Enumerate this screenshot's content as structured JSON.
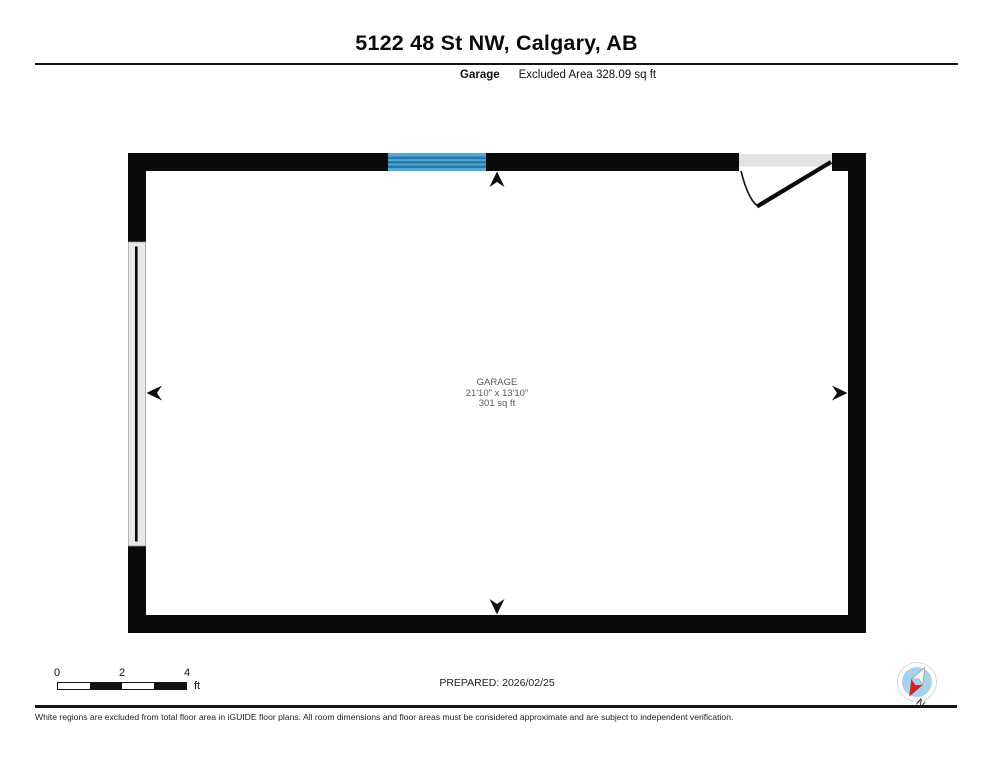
{
  "header": {
    "title": "5122 48 St NW, Calgary, AB",
    "floor_label": "Garage",
    "excluded_area": "Excluded Area 328.09 sq ft"
  },
  "room": {
    "name": "GARAGE",
    "dimensions": "21'10\" x 13'10\"",
    "area": "301 sq ft"
  },
  "footer": {
    "scale": {
      "ticks": [
        "0",
        "2",
        "4"
      ],
      "unit": "ft"
    },
    "prepared": "PREPARED: 2026/02/25",
    "compass_label": "N",
    "disclaimer": "White regions are excluded from total floor area in iGUIDE floor plans. All room dimensions and floor areas must be considered approximate and are subject to independent verification."
  },
  "colors": {
    "wall": "#0a0a0a",
    "window_light": "#55a7d4",
    "window_dark": "#2a78ad",
    "opening_gray": "#e2e2e2",
    "garage_door_gray": "#e8e8e8",
    "compass_blue": "#a7d4ec",
    "compass_red": "#d42028",
    "room_text": "#595959"
  }
}
